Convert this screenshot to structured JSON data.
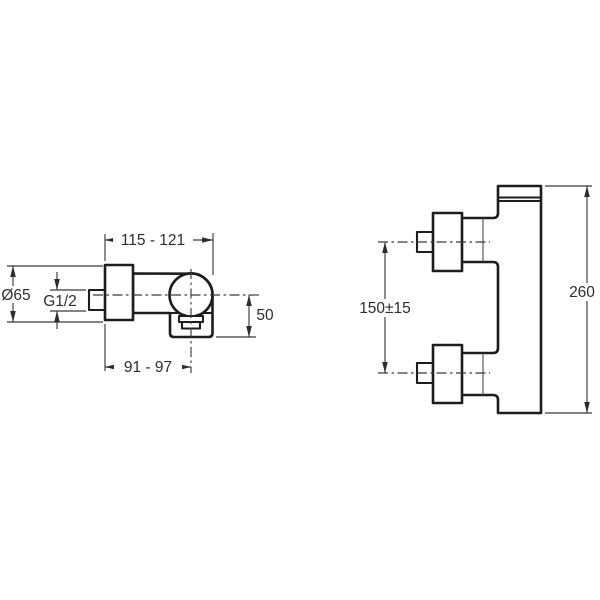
{
  "drawing": {
    "side_view": {
      "dims": {
        "top_width": "115 - 121",
        "flange_diameter": "Ø65",
        "inlet_thread": "G1/2",
        "outlet_drop": "50",
        "bottom_depth": "91 - 97"
      }
    },
    "front_view": {
      "dims": {
        "inlet_spacing": "150±15",
        "overall_height": "260"
      }
    },
    "colors": {
      "background": "#ffffff",
      "outline": "#1d1d1d",
      "dimension_line": "#3a3a3a",
      "text": "#2e2e2e"
    }
  }
}
